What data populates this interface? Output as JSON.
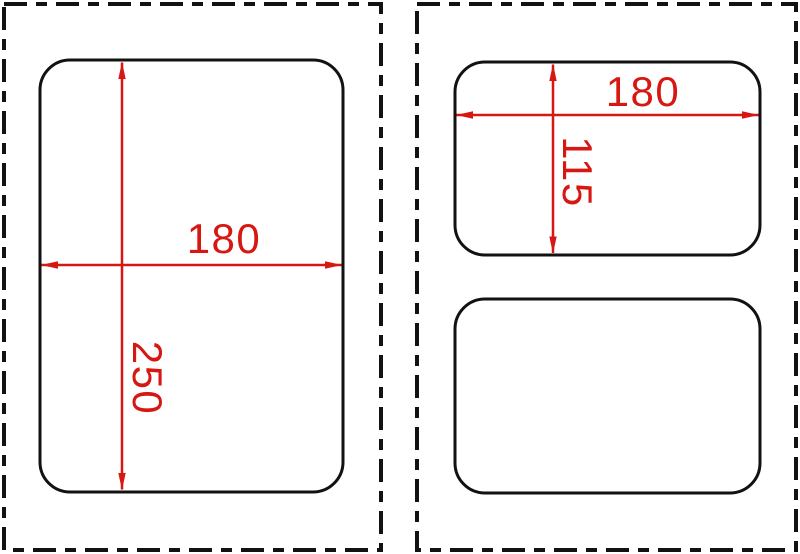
{
  "drawing_type": "technical-dimension-drawing",
  "colors": {
    "dimension_red": "#d71712",
    "outline_black": "#121212",
    "background": "#ffffff"
  },
  "left_panel": {
    "shape": "rounded-rectangle",
    "width_label": "180",
    "height_label": "250"
  },
  "right_panel": {
    "top_shape": {
      "shape": "rounded-rectangle",
      "width_label": "180",
      "height_label": "115"
    },
    "bottom_shape": {
      "shape": "rounded-rectangle",
      "dimensions_labeled": false
    }
  }
}
